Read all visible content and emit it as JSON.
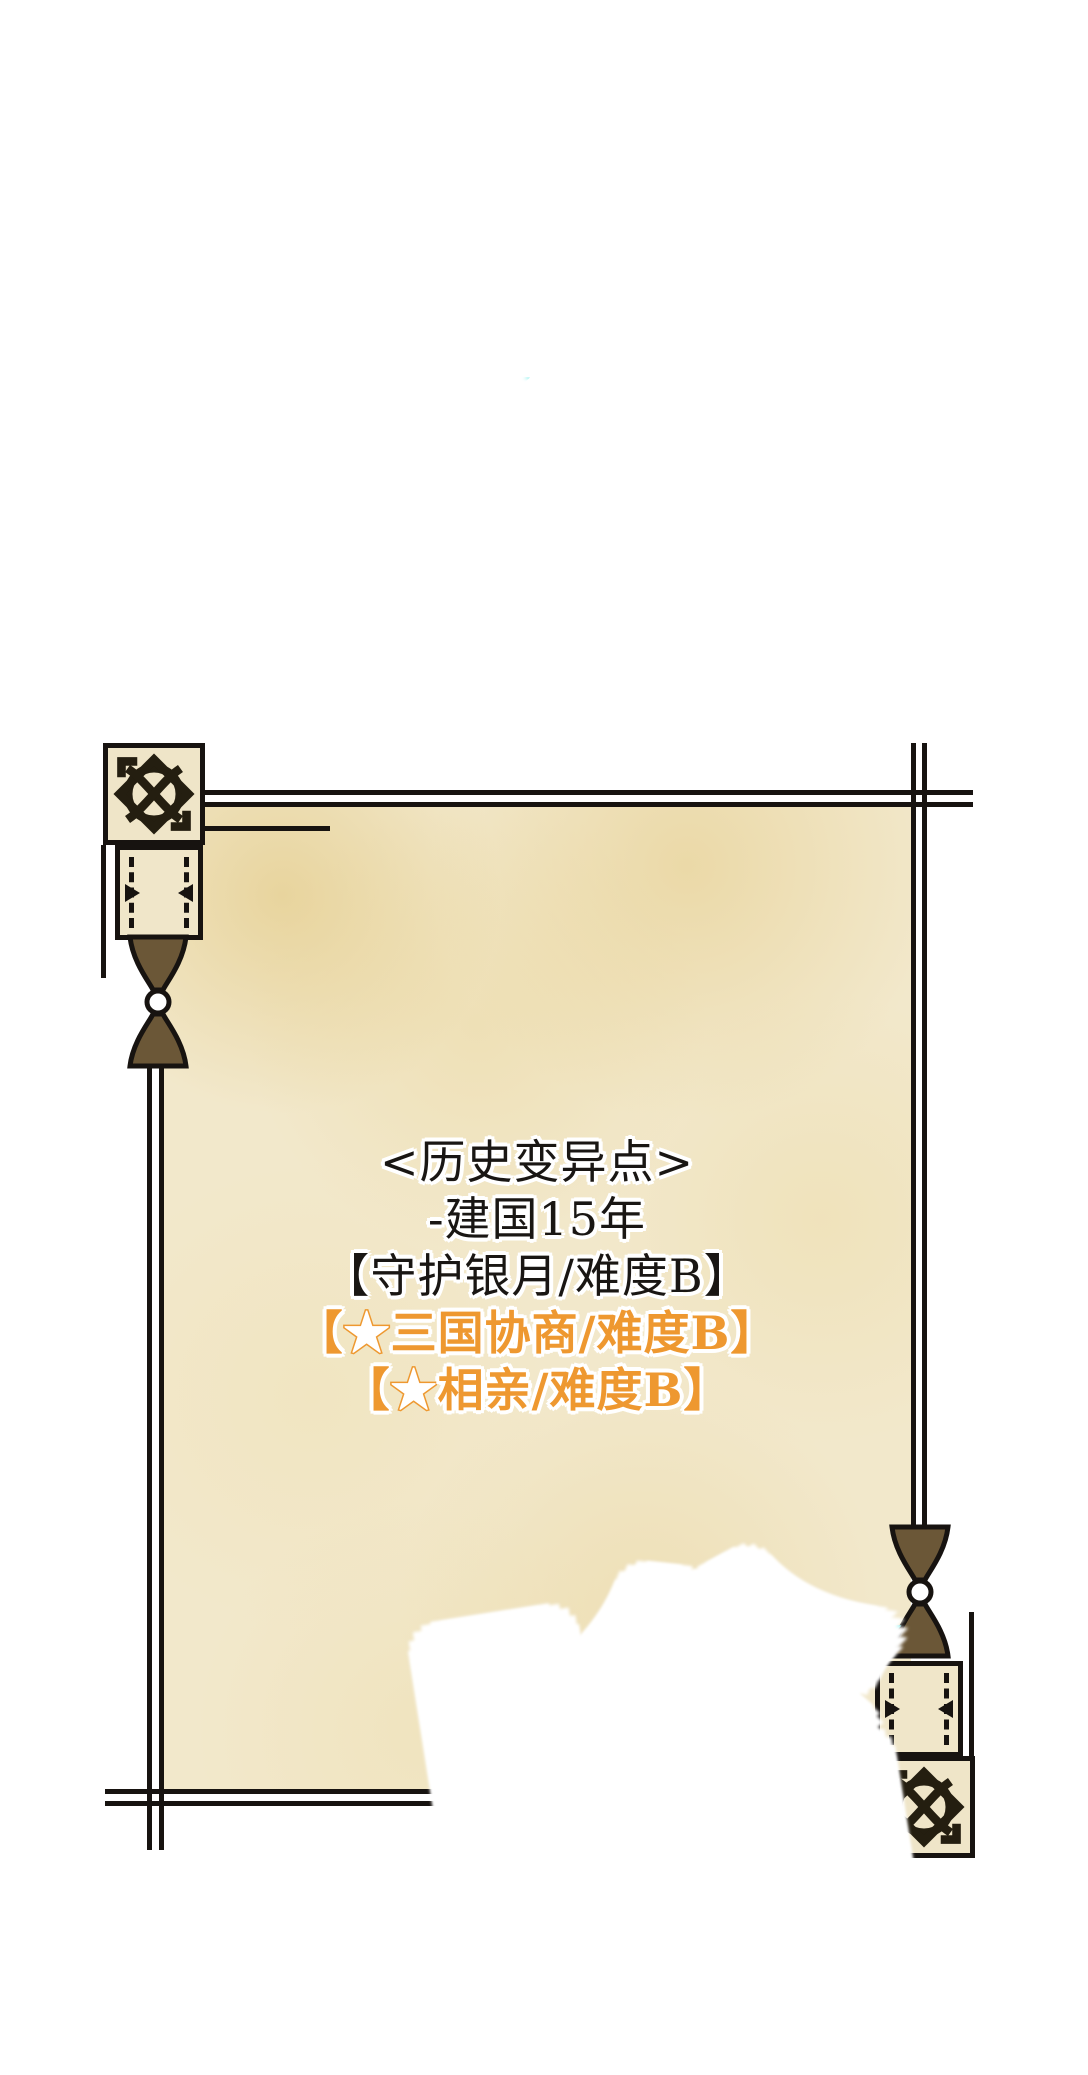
{
  "page": {
    "background": "#ffffff",
    "kind": "webtoon-panel"
  },
  "panel": {
    "type": "hanging-scroll-parchment",
    "colors": {
      "parchment": "#f2e8cb",
      "stain_yellow": "#e2c882",
      "frame_line": "#171310",
      "wood_brown": "#6b5737",
      "sfx_cyan": "#7deeec",
      "sfx_fill": "#ffffff",
      "quest_orange": "#ee9830",
      "text_black": "#191613",
      "halo_white": "#ffffff"
    },
    "ornaments": {
      "top_left": {
        "knot_icon": "celtic-knot",
        "finial_icon": "hourglass-finial",
        "knob_icon": "scroll-knob-box"
      },
      "bottom_right": {
        "knot_icon": "celtic-knot",
        "finial_icon": "hourglass-finial",
        "knob_icon": "scroll-knob-box"
      }
    },
    "text": {
      "title": "<历史变异点>",
      "era": "-建国15年",
      "quest_main": "【守护银月/难度B】",
      "quest_side1": {
        "open": "【",
        "star": "★",
        "rest": "三国协商/难度B】"
      },
      "quest_side2": {
        "open": "【",
        "star": "★",
        "rest": "相亲/难度B】"
      }
    },
    "sfx": {
      "top": "嗡",
      "bottom": "嗡"
    }
  }
}
